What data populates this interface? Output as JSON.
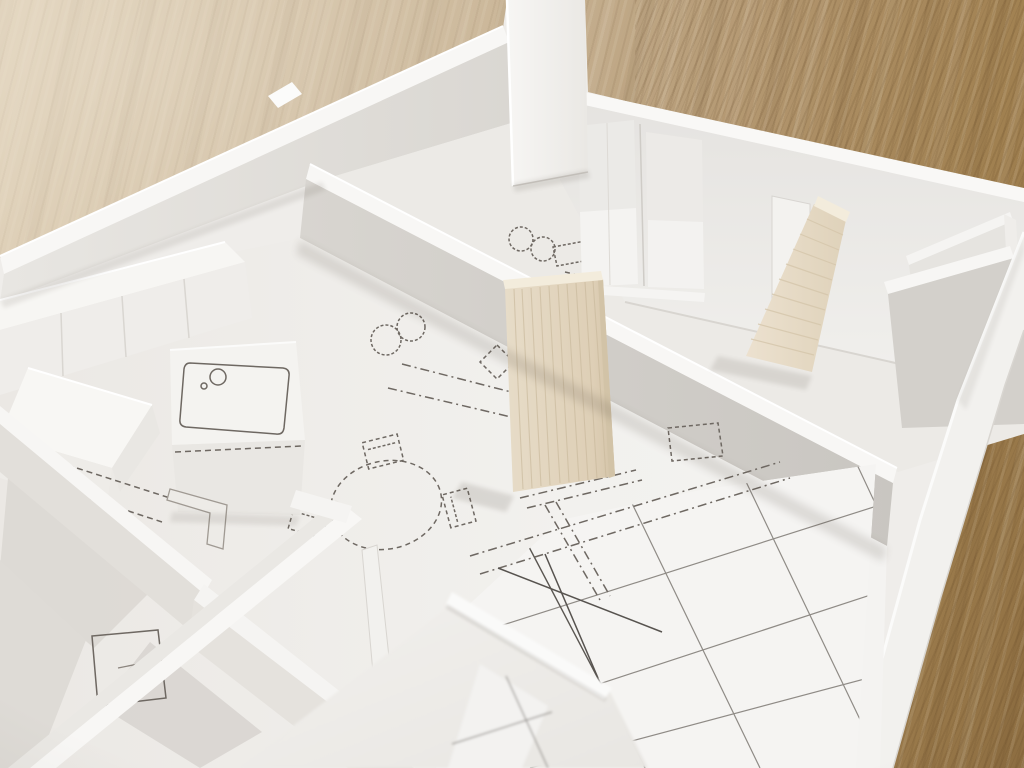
{
  "scene": {
    "type": "photograph",
    "subject": "architectural scale model of an apartment floor plan, white foam board on an oak table",
    "camera": "oblique top-down view, shallow depth of field (foreground and table edges blurred)",
    "objects": [
      {
        "name": "wood-table-surface",
        "desc": "light oak tabletop, diagonal grain, brighter out-of-focus upper-left, darker grain lower-right"
      },
      {
        "name": "model-floor-plate",
        "desc": "white board printed with floor plan line drawings"
      },
      {
        "name": "back-left-outer-wall",
        "desc": "long white foam wall running diagonally upper-right"
      },
      {
        "name": "tall-corner-wall",
        "desc": "tall white wall piece at top center, cropped by frame"
      },
      {
        "name": "back-wall-with-sliding-doors",
        "desc": "white wall with two recessed sliding door panels and an opening"
      },
      {
        "name": "interior-partition-wall",
        "desc": "long white-topped wall crossing the model from left junction to right wall"
      },
      {
        "name": "balsa-panel-center",
        "desc": "tan balsa wood partition standing mid-model, vertical grain"
      },
      {
        "name": "balsa-panel-right",
        "desc": "leaning tan balsa partition near right rooms, layered grain"
      },
      {
        "name": "right-closet-partitions",
        "desc": "small white shelf-like partition walls at right edge"
      },
      {
        "name": "right-outer-wall",
        "desc": "white perimeter wall running to bottom edge, table visible beyond"
      },
      {
        "name": "kitchen-cabinet-row",
        "desc": "row of white cabinet blocks along left wall with door seams"
      },
      {
        "name": "kitchen-island-sink",
        "desc": "white counter block with printed sink and faucet drawing"
      },
      {
        "name": "kitchen-island-block",
        "desc": "bright white angled box in left foreground"
      },
      {
        "name": "dining-table-drawing",
        "desc": "dashed round table with three dashed chairs printed on floor"
      },
      {
        "name": "burner-circles-drawing",
        "desc": "two pairs of small printed circles"
      },
      {
        "name": "dashed-diamond-drawing",
        "desc": "small dashed rotated square"
      },
      {
        "name": "dashed-rect-drawing",
        "desc": "dashed square in right room"
      },
      {
        "name": "tiled-floor-grid",
        "desc": "printed tile grid in lower-right room"
      },
      {
        "name": "foreground-walls",
        "desc": "blurred white walls closest to camera with a doorway opening"
      },
      {
        "name": "bathroom-walls-bottom-left",
        "desc": "crossing white wall strips forming small rooms, printed door and L-shaped fixture"
      }
    ]
  },
  "palette": {
    "wood_light": "#cdbb9e",
    "wood_mid1": "#c0a987",
    "wood_mid2": "#b1946c",
    "wood_dark": "#a08050",
    "wood_darker": "#8f6f42",
    "wall_top": "#f8f7f5",
    "wall_face": "#e6e4e0",
    "wall_face_dark": "#d3d0cb",
    "floor": "#eeebe7",
    "floor_bright": "#f4f3f1",
    "plan_line": "#6e6862",
    "tile_line": "#8f8b86",
    "balsa": "#e5d9c4",
    "balsa_streak": "#c9b99c",
    "balsa_top": "#f3ecdc",
    "balsa_right": "#e9dfcc",
    "balsa_right_streak": "#d5c6ab",
    "shadow": "#4a4036"
  }
}
